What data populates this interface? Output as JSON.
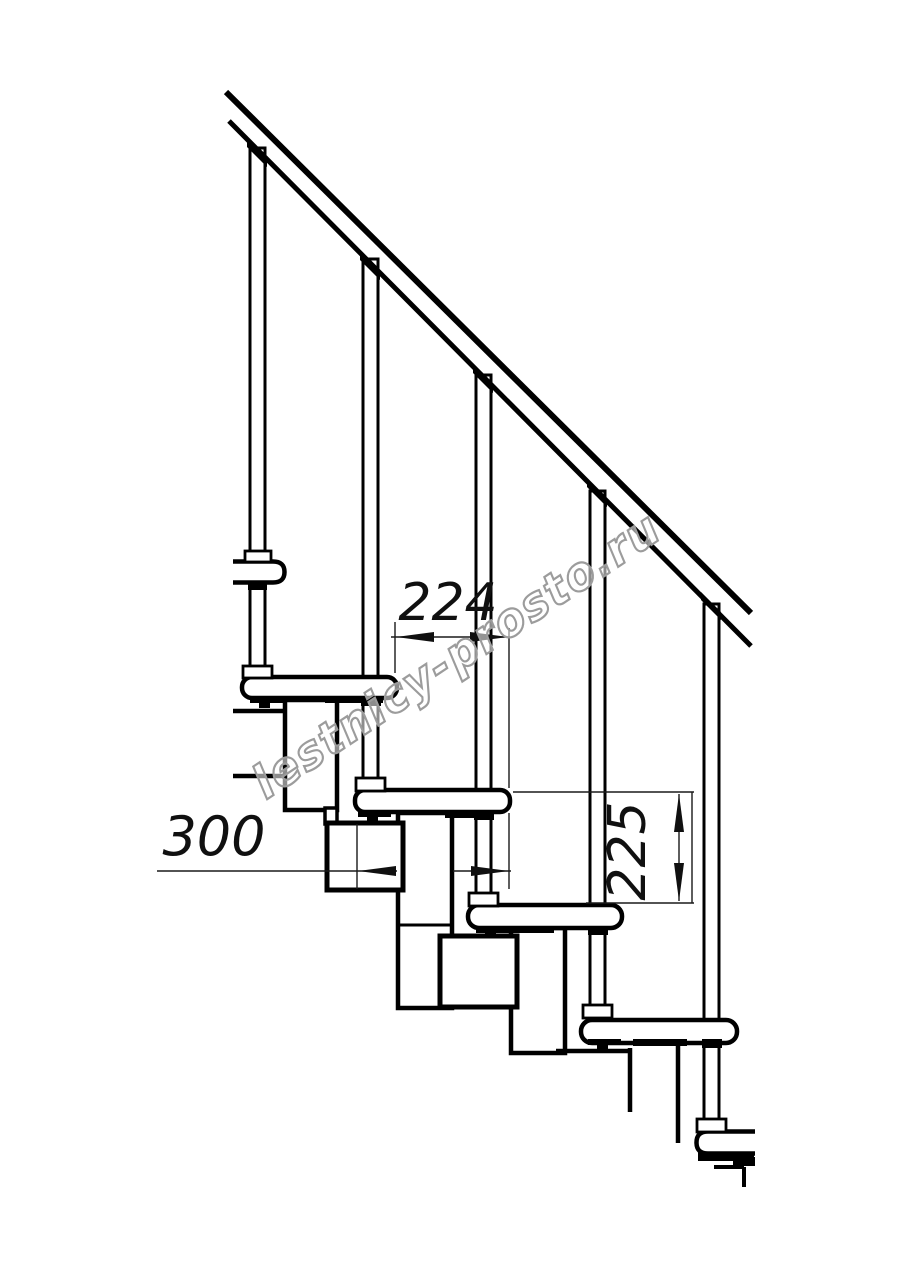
{
  "drawing": {
    "type": "technical line drawing",
    "subject": "modular staircase side elevation fragment with handrail, balusters, treads and support modules",
    "background_color": "#ffffff",
    "line_color": "#000000",
    "dimension_line_color": "#1a1a1a",
    "dimensions": {
      "run": {
        "value": "224",
        "orientation": "horizontal",
        "meaning": "horizontal step run between tread noses"
      },
      "tread_depth": {
        "value": "300",
        "orientation": "horizontal",
        "meaning": "tread depth"
      },
      "rise": {
        "value": "225",
        "orientation": "vertical",
        "meaning": "step rise between tread tops"
      }
    },
    "watermark": {
      "text": "lestnicy-prosto.ru",
      "color": "#9c9c9c",
      "angle_deg": -33.5
    }
  }
}
